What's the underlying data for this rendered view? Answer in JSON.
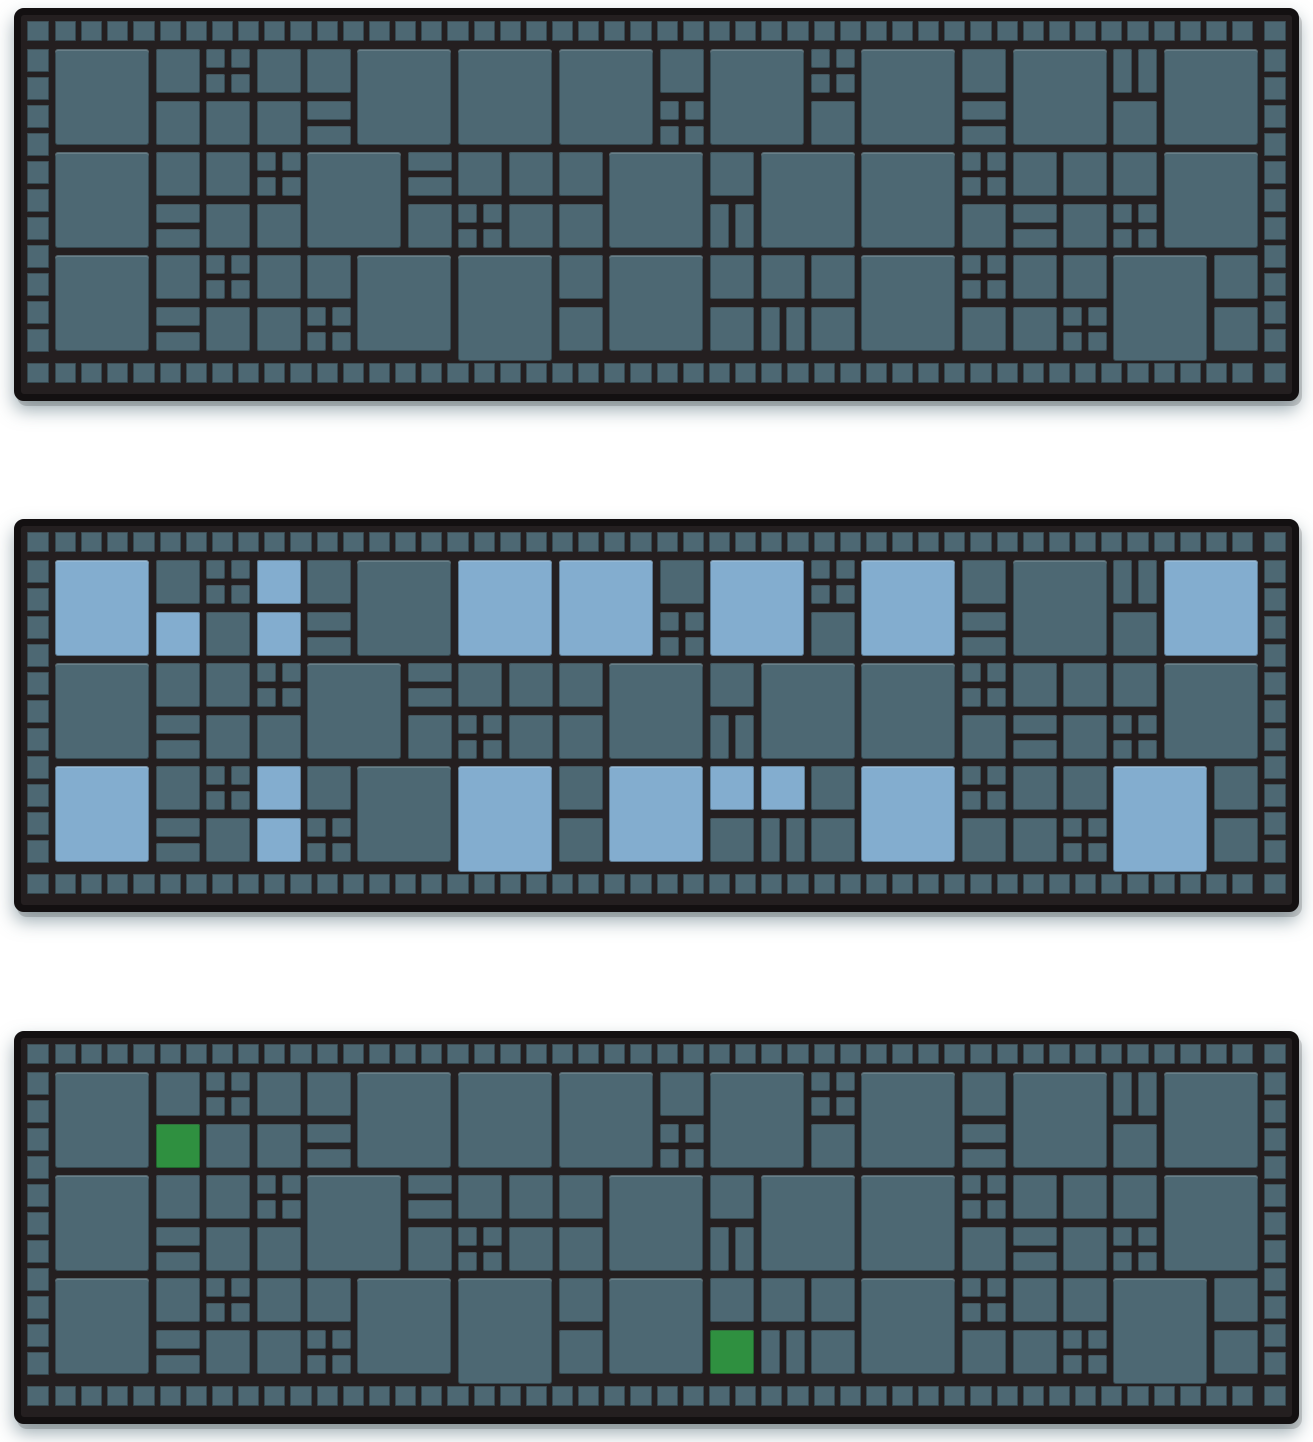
{
  "page": {
    "background": "#ffffff",
    "description_labels": {}
  },
  "colors": {
    "frame": "#131011",
    "mortar": "#241f20",
    "tile_teal": "#4d6873",
    "highlight_blue": "#83adcf",
    "highlight_green": "#2f9040"
  },
  "tilemap": [
    "2.1q112.2.2.12.q2.12.h2.",
    "..111v......q..1..v..1..",
    "2.11q2.v1112.12.2.q1112.",
    "..v11..1q11..h....1v1q..",
    "2.1q112.B.12.1112.q11B.1",
    "..v11q....1..1h1..11q..1"
  ],
  "panels": [
    {
      "id": "top",
      "name": "pattern-board-plain",
      "highlight_color": null,
      "highlights": []
    },
    {
      "id": "middle",
      "name": "pattern-board-blue-highlights",
      "highlight_color": "highlight_blue",
      "highlights": [
        [
          0,
          0
        ],
        [
          2,
          1
        ],
        [
          4,
          0
        ],
        [
          4,
          1
        ],
        [
          8,
          0
        ],
        [
          10,
          0
        ],
        [
          13,
          0
        ],
        [
          16,
          0
        ],
        [
          22,
          0
        ],
        [
          0,
          4
        ],
        [
          4,
          4
        ],
        [
          4,
          5
        ],
        [
          8,
          4
        ],
        [
          11,
          4
        ],
        [
          13,
          4
        ],
        [
          14,
          4
        ],
        [
          16,
          4
        ],
        [
          21,
          4
        ]
      ]
    },
    {
      "id": "bottom",
      "name": "pattern-board-green-selections",
      "highlight_color": "highlight_green",
      "highlights": [
        [
          2,
          1
        ],
        [
          13,
          5
        ]
      ]
    }
  ]
}
